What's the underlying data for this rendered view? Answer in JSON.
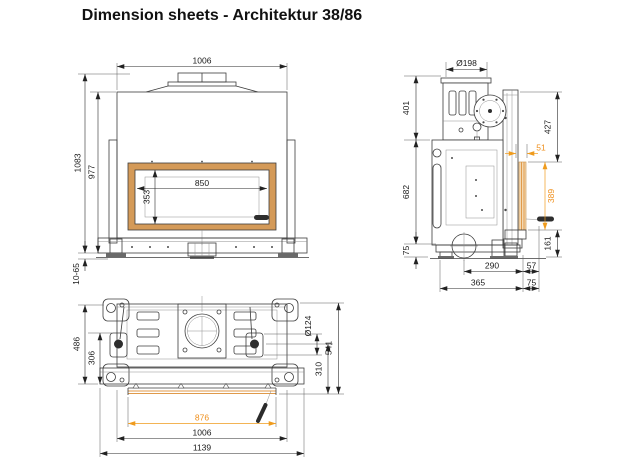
{
  "title": "Dimension sheets - Architektur 38/86",
  "colors": {
    "line": "#3c3c3c",
    "dim_text": "#1a1a1a",
    "highlight": "#ef9b1d",
    "frame_band": "#d49a58"
  },
  "front_view": {
    "label": "front view",
    "dims": {
      "overall_width": "1006",
      "overall_height": "1083",
      "body_height": "977",
      "foot_adjust_range": "10-65",
      "glass_width": "850",
      "glass_height": "353"
    }
  },
  "side_view": {
    "label": "side view",
    "dims": {
      "flue_diameter": "Ø198",
      "upper_section_height": "401",
      "body_height": "682",
      "base_height": "75",
      "top_to_glass": "427",
      "glass_frame_depth": "51",
      "glass_height": "389",
      "glass_to_floor": "161",
      "flue_axis_to_front": "290",
      "front_to_glass": "57",
      "base_depth": "365",
      "base_to_glass": "75"
    }
  },
  "bottom_view": {
    "label": "bottom view",
    "dims": {
      "body_depth": "486",
      "inner_depth": "306",
      "inlet_diameter": "Ø124",
      "latch_to_front": "310",
      "overall_depth": "541",
      "glass_width": "876",
      "body_width": "1006",
      "overall_width": "1139"
    }
  }
}
